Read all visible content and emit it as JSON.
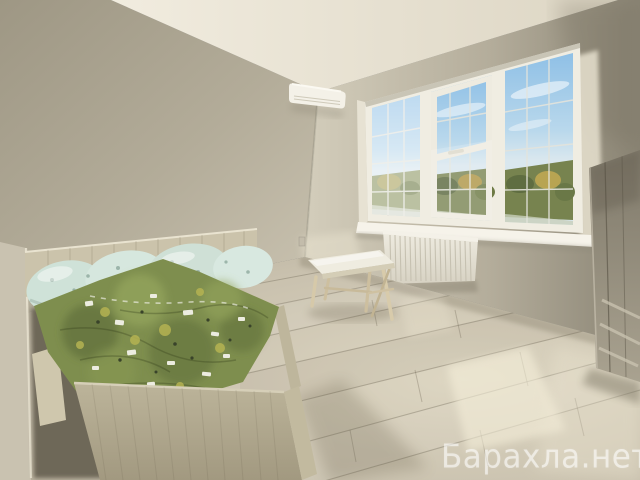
{
  "watermark": {
    "text": "Барахла.нет",
    "color": "#ffffff",
    "opacity": 0.55
  },
  "scene": {
    "kind": "interior-photo",
    "room": "sunlit bedroom, corner view toward a bright three-pane window",
    "objects": [
      "bed with light-ash wood frame and tall footboard panel",
      "green child-print duvet, crinkled",
      "four mint-blue pillows along headboard",
      "white split air-conditioner near ceiling corner",
      "white PVC window, three panes with thin muntin grid, blue sky and autumn trees outside",
      "bright white window sill",
      "white panel radiator with vertical fins under window",
      "small plywood A-frame bench in front of radiator",
      "tall wardrobe in shadow at right edge",
      "light oak laminate floor with diagonal planks and sun patches"
    ],
    "palette": {
      "ceiling": "#efeadd",
      "wall_shaded": "#a29b88",
      "wall_lit": "#d2ccba",
      "wall_dark_right": "#8a8474",
      "floor": "#c9c1ae",
      "sun_patch": "#f2ecd9",
      "sky_top": "#8fc0e6",
      "sky_low": "#d9e7ee",
      "foliage": "#7c8756",
      "foliage_amber": "#b99a44",
      "duvet_green": "#7e8e4e",
      "pillow_mint": "#d3e4da",
      "bed_wood": "#b8b097",
      "frame_white": "#f0ede2"
    }
  }
}
